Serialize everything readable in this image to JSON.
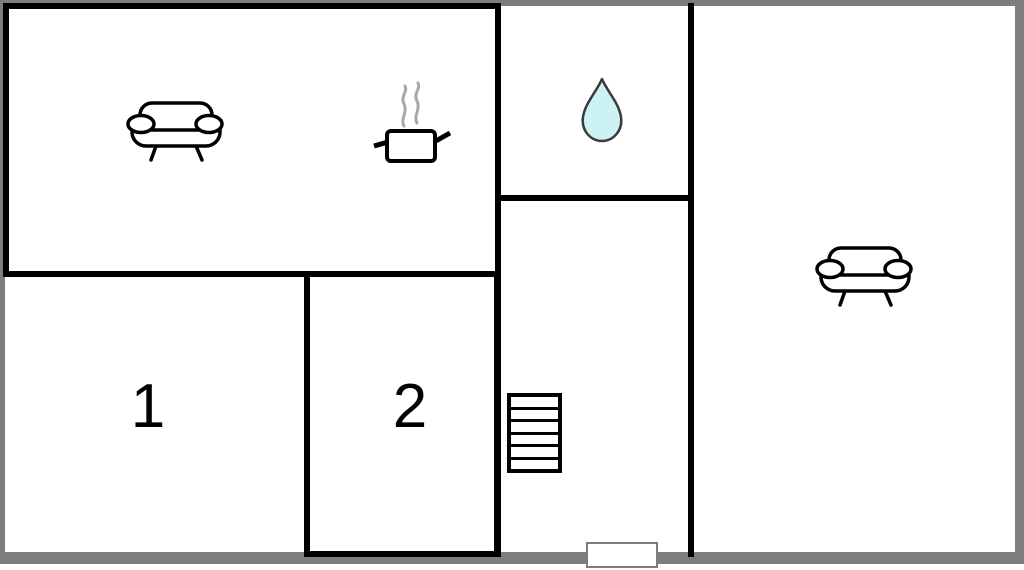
{
  "page": {
    "type": "floor-plan"
  },
  "rooms": {
    "room1": {
      "label": "1"
    },
    "room2": {
      "label": "2"
    }
  },
  "stairs": {
    "steps": 6
  },
  "icons": {
    "top_left_room": [
      "sofa-icon",
      "cooking-pot-icon",
      "steam-icon"
    ],
    "wet_room": [
      "water-drop-icon"
    ],
    "right_room": [
      "sofa-icon"
    ],
    "hallway": [
      "stairs-icon",
      "entrance-door"
    ]
  },
  "colors": {
    "wall": "#000000",
    "outer_frame": "#7d7d7d",
    "water_drop_fill": "#ccf2f5",
    "water_drop_stroke": "#3a3a3a",
    "steam": "#a8a8a8",
    "door_border": "#7d7d7d"
  }
}
